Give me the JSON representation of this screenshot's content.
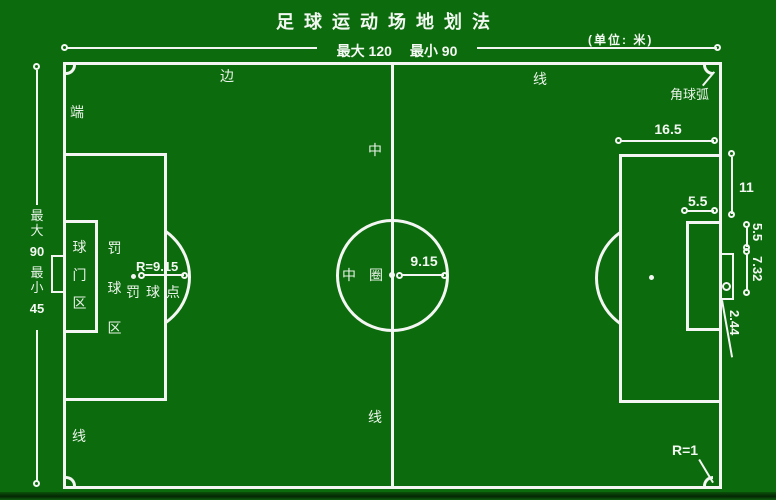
{
  "colors": {
    "field_green": "#0c6b0c",
    "line_white": "#f4f6f4",
    "text_white": "#e9f3e9"
  },
  "title": "足球运动场地划法",
  "unit_note": "(单位: 米)",
  "top_dim": {
    "max": "最大 120",
    "min": "最小 90"
  },
  "left_dim": {
    "max_label": "最大",
    "max_value": "90",
    "min_label": "最小",
    "min_value": "45"
  },
  "pitch_labels": {
    "side_left": "边",
    "side_right": "线",
    "end_top": "端",
    "end_bottom": "线",
    "mid_top": "中",
    "mid_bottom": "线",
    "circle_a": "中",
    "circle_b": "圈"
  },
  "center": {
    "radius": "9.15"
  },
  "left_area": {
    "penalty_radius": "R=9.15",
    "penalty_spot": "罚球点",
    "penalty_area": "罚球区",
    "goal_area": "球门区"
  },
  "right_dims": {
    "penalty_depth": "16.5",
    "penalty_spot_dist": "11",
    "goal_area_depth": "5.5",
    "goal_post_offset": "5.5",
    "goal_width": "7.32",
    "goal_height": "2.44",
    "corner_arc_label": "角球弧",
    "corner_radius": "R=1"
  }
}
